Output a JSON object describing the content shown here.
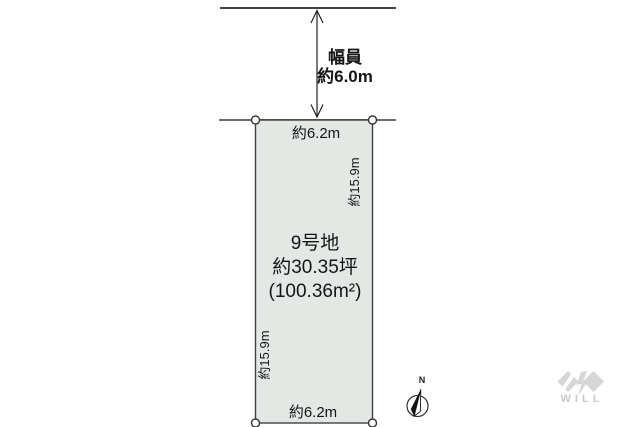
{
  "colors": {
    "background": "#ffffff",
    "plot_fill": "#e3e8e5",
    "plot_border": "#3f3f3f",
    "road_line_top": "#454545",
    "road_line_bottom": "#6e6e6e",
    "text": "#111111",
    "logo_gray": "#d6d6d6",
    "logo_text": "#c9c9c9"
  },
  "road": {
    "width_label": "幅員",
    "width_value": "約6.0m"
  },
  "plot": {
    "name": "9号地",
    "area_tsubo": "約30.35坪",
    "area_m2": "(100.36m²)",
    "dim_top": "約6.2m",
    "dim_bottom": "約6.2m",
    "dim_left": "約15.9m",
    "dim_right": "約15.9m"
  },
  "compass": {
    "north": "N"
  },
  "logo": {
    "text": "WILL"
  }
}
